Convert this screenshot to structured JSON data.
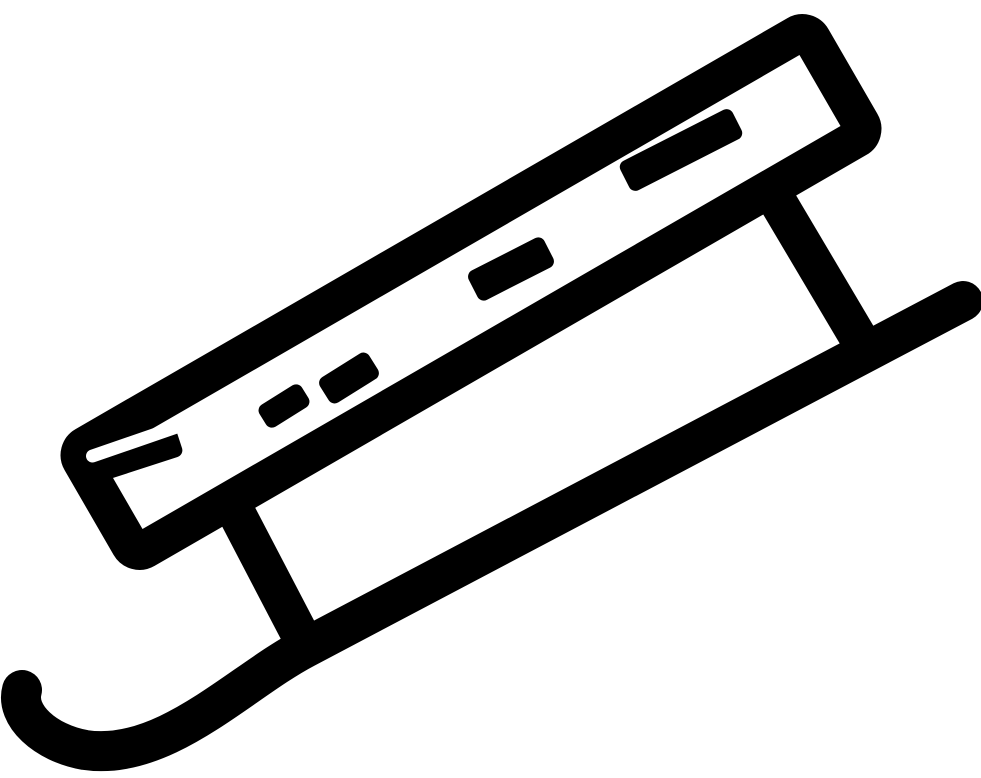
{
  "meta": {
    "type": "icon",
    "subject": "sled",
    "canvas_width": 981,
    "canvas_height": 778
  },
  "colors": {
    "foreground": "#000000",
    "background": "#ffffff"
  },
  "icon": {
    "name": "sled-icon",
    "viewBox": "0 0 981 778",
    "deck": {
      "name": "sled-deck-outline",
      "cx": 471,
      "cy": 292,
      "length": 844,
      "width": 120,
      "rx": 11,
      "stroke_width": 38,
      "rotation": -30
    },
    "slats": [
      {
        "name": "deck-slat-right",
        "cx": 681,
        "cy": 150,
        "length": 126,
        "width": 33,
        "rotation": -27,
        "rx": 7
      },
      {
        "name": "deck-slat-middle",
        "cx": 511,
        "cy": 269,
        "length": 85,
        "width": 33,
        "rotation": -27,
        "rx": 7
      },
      {
        "name": "deck-slat-small-upper",
        "cx": 349,
        "cy": 378,
        "length": 58,
        "width": 30,
        "rotation": -32,
        "rx": 7
      },
      {
        "name": "deck-slat-small-lower",
        "cx": 284,
        "cy": 406,
        "length": 50,
        "width": 26,
        "rotation": -32,
        "rx": 7
      },
      {
        "name": "deck-slat-left-edge",
        "cx": 132,
        "cy": 456,
        "length": 100,
        "width": 30,
        "rotation": -18,
        "rx": 7
      }
    ],
    "slit": {
      "name": "deck-left-slit",
      "cx": 136,
      "cy": 441,
      "length": 105,
      "width": 13,
      "rotation": -19,
      "rx": 6.5
    },
    "legs": [
      {
        "name": "sled-leg-left",
        "x1": 236,
        "y1": 512,
        "x2": 308,
        "y2": 650,
        "stroke_width": 38
      },
      {
        "name": "sled-leg-right",
        "x1": 775,
        "y1": 197,
        "x2": 868,
        "y2": 354,
        "stroke_width": 38
      }
    ],
    "runner": {
      "name": "sled-runner",
      "path": "M 963 301 L 305 648 C 240 682 165 762 85 750 C 45 743 15 715 22 690",
      "stroke_width": 40
    }
  }
}
